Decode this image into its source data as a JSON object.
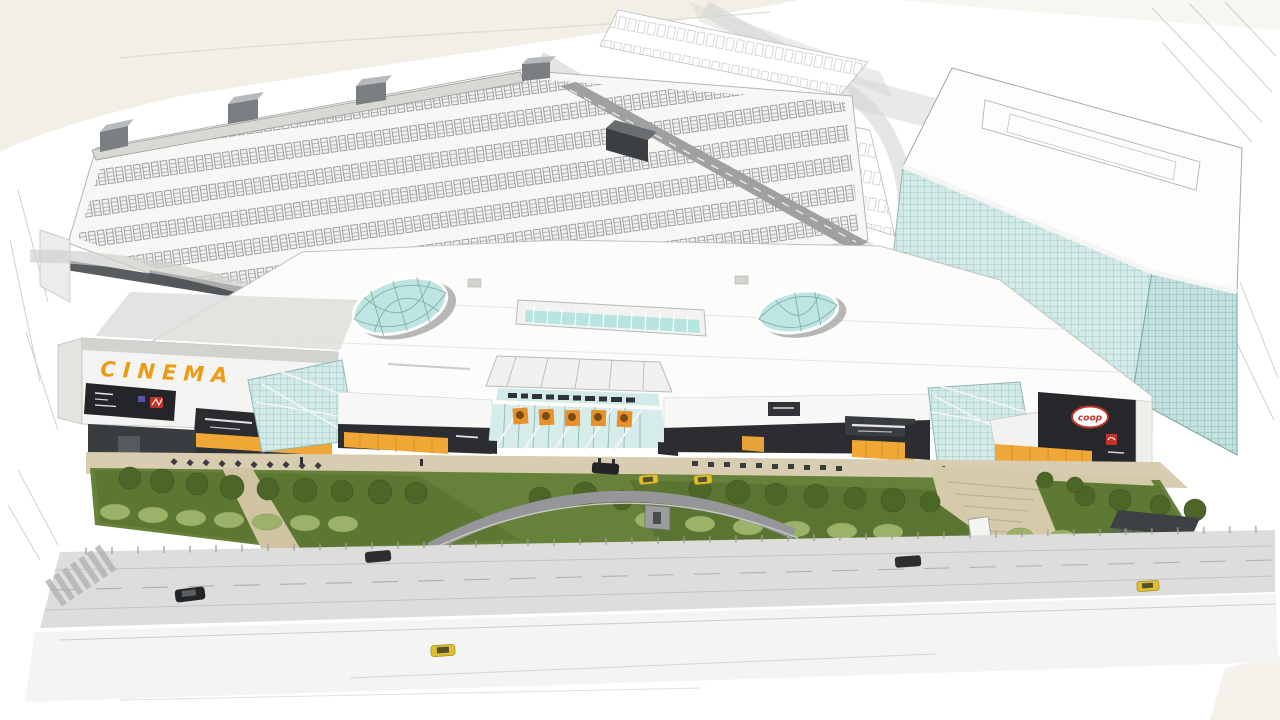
{
  "scene": {
    "medium": "architectural concept sketch rendering",
    "view": "aerial three-quarter perspective of a shopping mall complex",
    "elements": {
      "mall": "long white shopping centre with dark storefront band and yellow awnings",
      "cinema_wing": "left wing carrying orange CINEMA lettering and billboard signs",
      "rooftop_parking": "large parking deck behind the mall filled with rows of sketched cars",
      "office_tower": "teal glass curtain-wall office slab on the right",
      "skylights": "two oval glass dome skylights and one barrel-vault skylight strip",
      "entrance_atrium": "central glass entrance canopy with orange banners and sign band",
      "forecourt": "lawn with trees and bushes, curved grey drop-off drive, beige plazas, monument, kiosk",
      "streets": "foreground boulevard with crosswalk, cars and yellow taxis, faint outer highway"
    },
    "signs": {
      "cinema": "CINEMA",
      "supermarket_logo": "coop"
    },
    "counts": {
      "skylight_domes": 2,
      "entrance_banners": 5,
      "stair_towers": 4,
      "taxis": 4,
      "dark_cars": 4
    },
    "palette": {
      "paper": "#ffffff",
      "wash": "#f1eee3",
      "sketch_line": "#c6c4bc",
      "roof_white": "#fbfbfa",
      "glass_teal": "#d3ebe8",
      "glass_grid": "#8fbcb8",
      "storefront_dark": "#2b2d30",
      "awning_yellow": "#f0a735",
      "cinema_orange": "#ee9a15",
      "logo_red": "#c23427",
      "lawn_green": "#66813a",
      "tree_green": "#4c6628",
      "bush_green": "#9db269",
      "plaza_beige": "#d8cdb0",
      "road_gray": "#dddddb",
      "drive_gray": "#96969a",
      "taxi_yellow": "#ddbf2f",
      "car_black": "#222426"
    }
  }
}
